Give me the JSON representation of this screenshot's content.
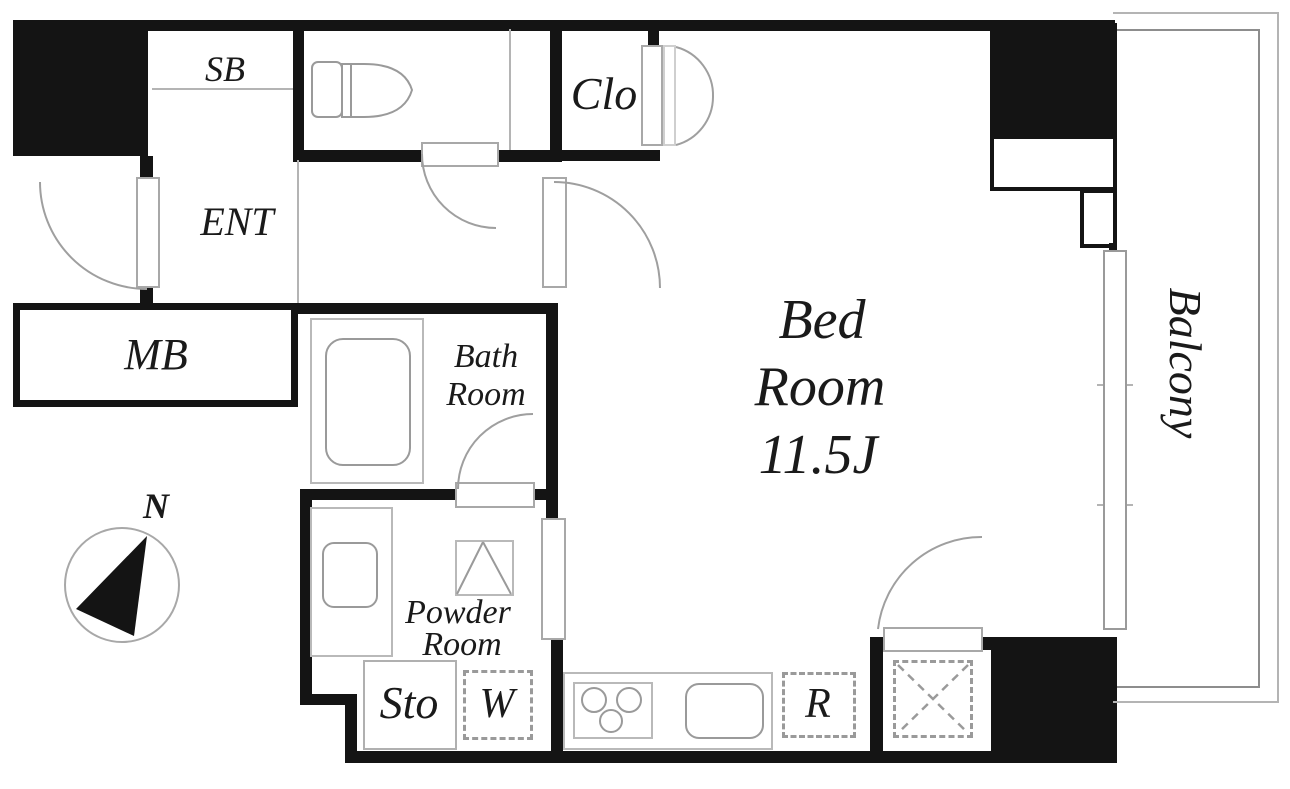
{
  "plan_title": "Studio apartment floor plan",
  "rooms": {
    "shoe_box": {
      "label": "SB"
    },
    "entrance": {
      "label": "ENT"
    },
    "closet": {
      "label": "Clo"
    },
    "meter_box": {
      "label": "MB"
    },
    "bathroom": {
      "label_line1": "Bath",
      "label_line2": "Room"
    },
    "powder_room": {
      "label_line1": "Powder",
      "label_line2": "Room"
    },
    "bedroom": {
      "label_line1": "Bed",
      "label_line2": "Room",
      "size": "11.5J"
    },
    "storage": {
      "label": "Sto"
    },
    "washer_space": {
      "label": "W"
    },
    "refrigerator_space": {
      "label": "R"
    },
    "balcony": {
      "label": "Balcony"
    }
  },
  "compass": {
    "north_label": "N"
  },
  "colors": {
    "wall": "#141414",
    "fixture_outline": "#9a9a9a",
    "balcony_line": "#b4b4b4",
    "text": "#1a1a1a",
    "background": "#ffffff"
  }
}
